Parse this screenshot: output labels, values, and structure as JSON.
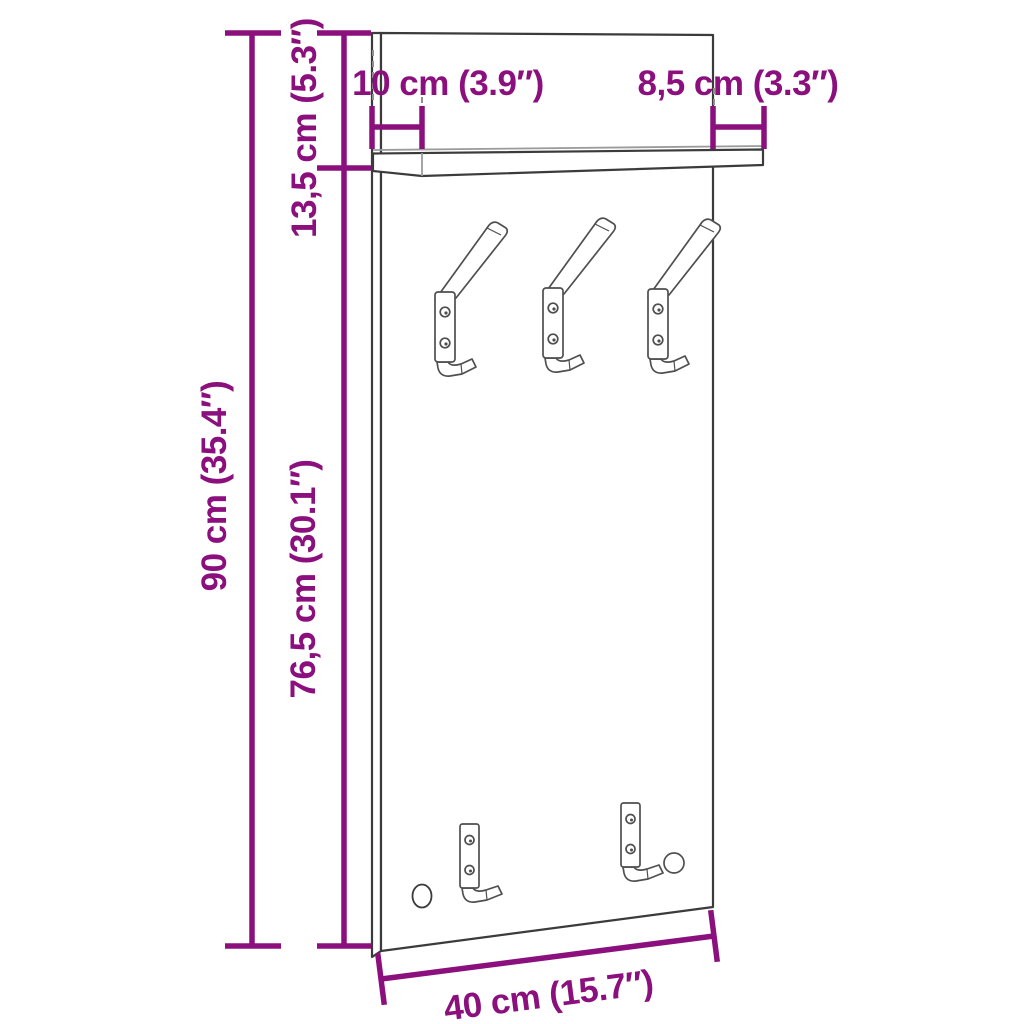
{
  "page": {
    "type": "product-dimension-diagram",
    "subject": "wall-mounted coat rack panel with top shelf, three double hooks, two single hooks and one mounting hole",
    "background": "#ffffff"
  },
  "colors": {
    "dimension_accent": "#8b107d",
    "drawing_outline": "#3b3b3b",
    "drawing_light": "#9b9b9b"
  },
  "labels": {
    "total_height": "90 cm (35.4″)",
    "lower_height": "76,5 cm (30.1″)",
    "upper_height": "13,5 cm (5.3″)",
    "shelf_depth_left": "10 cm (3.9″)",
    "shelf_depth_right": "8,5 cm (3.3″)",
    "width": "40 cm (15.7″)"
  },
  "figure": {
    "upper_double_hooks": 3,
    "lower_single_hooks": 2,
    "has_shelf": true,
    "has_mounting_hole": true
  }
}
